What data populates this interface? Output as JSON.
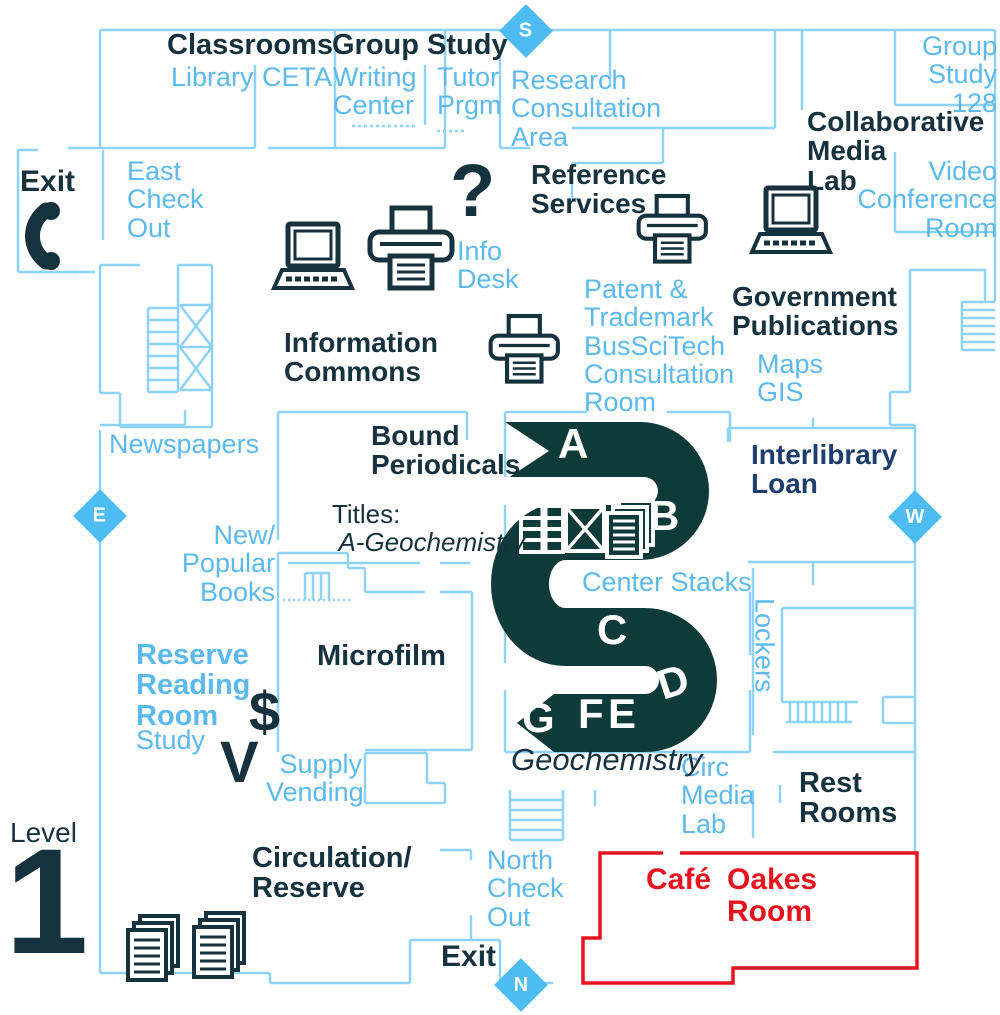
{
  "palette": {
    "heading_dark": "#15323e",
    "stacks_dark": "#0e3a3a",
    "interlibrary_navy": "#1d3d6e",
    "label_blue": "#5cb9ec",
    "wall_blue": "#8ed2f6",
    "diamond_blue": "#4dbcf2",
    "cafe_red": "#e8131f",
    "white": "#ffffff"
  },
  "compass": {
    "south": "S",
    "east": "E",
    "west": "W",
    "north": "N"
  },
  "level": {
    "label": "Level",
    "number": "1"
  },
  "labels": {
    "classrooms": "Classrooms",
    "library": "Library",
    "ceta": "CETA",
    "group_study": "Group Study",
    "writing_center": [
      "Writing",
      "Center"
    ],
    "tutor_prgm": [
      "Tutor",
      "Prgm"
    ],
    "research_area": [
      "Research",
      "Consultation",
      "Area"
    ],
    "group_study_128": [
      "Group",
      "Study",
      "128"
    ],
    "collaborative": [
      "Collaborative",
      "Media",
      "Lab"
    ],
    "video_conference": [
      "Video",
      "Conference",
      "Room"
    ],
    "exit_top": "Exit",
    "east_checkout": [
      "East",
      "Check",
      "Out"
    ],
    "question_mark": "?",
    "info_desk": [
      "Info",
      "Desk"
    ],
    "reference": [
      "Reference",
      "Services"
    ],
    "patent": [
      "Patent &",
      "Trademark",
      "BusSciTech",
      "Consultation",
      "Room"
    ],
    "government": [
      "Government",
      "Publications"
    ],
    "maps_gis": [
      "Maps",
      "GIS"
    ],
    "information_commons": [
      "Information",
      "Commons"
    ],
    "newspapers": "Newspapers",
    "bound_periodicals": [
      "Bound",
      "Periodicals"
    ],
    "titles_prefix": "Titles:",
    "titles_range": "A-Geochemistry",
    "interlibrary": [
      "Interlibrary",
      "Loan"
    ],
    "new_popular": [
      "New/",
      "Popular",
      "Books"
    ],
    "center_stacks": "Center Stacks",
    "lockers": "Lockers",
    "reserve_reading": [
      "Reserve",
      "Reading",
      "Room"
    ],
    "study": "Study",
    "microfilm": "Microfilm",
    "dollar": "$",
    "vending_v": "V",
    "supply_vending": [
      "Supply",
      "Vending"
    ],
    "circ_media": [
      "Circ",
      "Media",
      "Lab"
    ],
    "rest_rooms": [
      "Rest",
      "Rooms"
    ],
    "geochemistry": "Geochemistry",
    "circulation": [
      "Circulation/",
      "Reserve"
    ],
    "north_checkout": [
      "North",
      "Check",
      "Out"
    ],
    "exit_bottom": "Exit",
    "cafe": "Café",
    "oakes": [
      "Oakes",
      "Room"
    ]
  },
  "stacks": {
    "letters": {
      "a": "A",
      "b": "B",
      "c": "C",
      "d": "D",
      "e": "E",
      "f": "F",
      "g": "G"
    }
  }
}
